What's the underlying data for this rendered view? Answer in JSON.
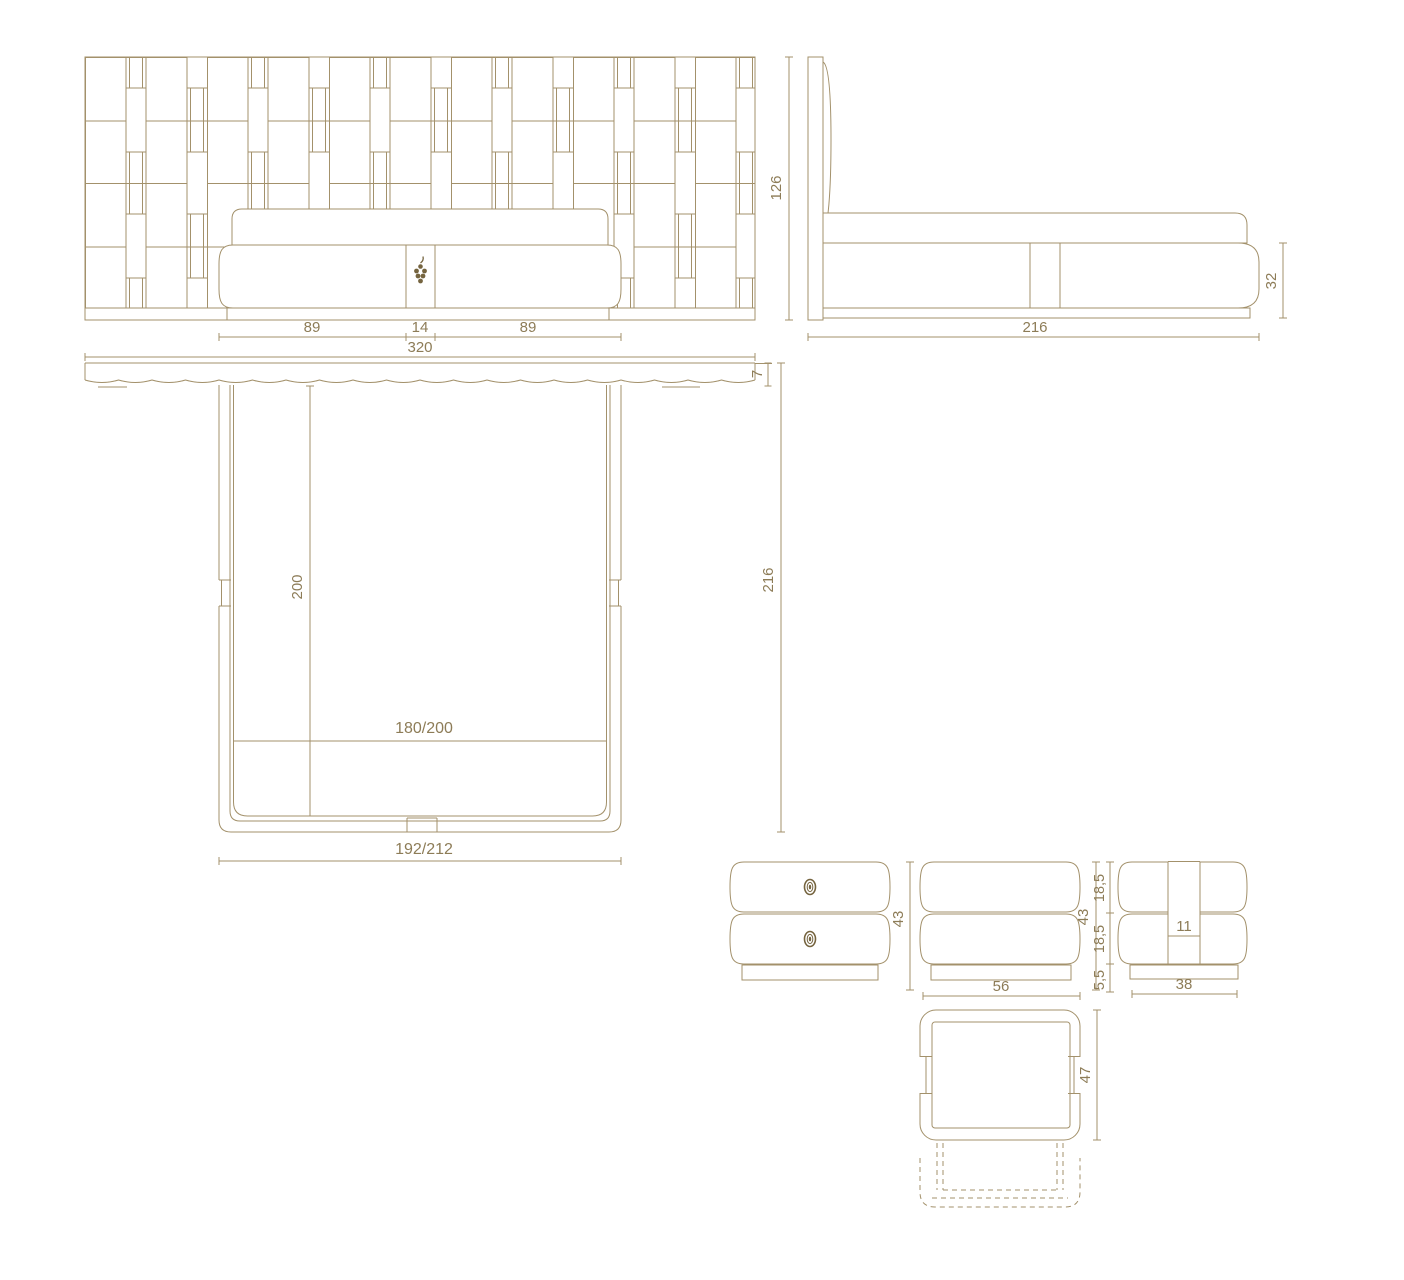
{
  "document": {
    "type": "furniture technical dimension drawing",
    "background": "#ffffff",
    "colors": {
      "line": "#a3916b",
      "text": "#8d7c57",
      "accent": "#75643f"
    }
  },
  "views": {
    "bed_front": {
      "label": "bed front elevation with woven headboard panel",
      "dims": {
        "bed_left": "89",
        "strap_width": "14",
        "bed_right": "89",
        "total_width": "320",
        "panel_height": "126"
      }
    },
    "bed_side": {
      "label": "bed side elevation",
      "dims": {
        "total_depth": "216",
        "base_height": "32"
      }
    },
    "bed_top": {
      "label": "bed top plan",
      "dims": {
        "panel_thickness": "7",
        "mattress_length": "200",
        "total_depth": "216",
        "mattress_width": "180",
        "mattress_width_alt": "/200",
        "frame_width": "192",
        "frame_width_alt": "/212"
      }
    },
    "nightstand_front": {
      "label": "nightstand front elevation",
      "dims": {
        "height": "43"
      }
    },
    "nightstand_back": {
      "label": "nightstand rear elevation",
      "dims": {
        "height": "43",
        "width": "56",
        "upper_drawer": "18,5",
        "lower_drawer": "18,5",
        "plinth": "5,5"
      }
    },
    "nightstand_side": {
      "label": "nightstand side elevation",
      "dims": {
        "strap_width": "11",
        "depth": "38"
      }
    },
    "nightstand_top": {
      "label": "nightstand top plan with open drawer",
      "dims": {
        "depth": "47"
      }
    }
  }
}
